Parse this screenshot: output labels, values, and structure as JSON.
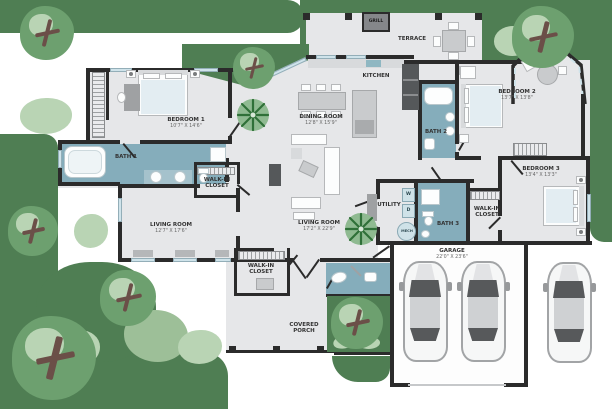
{
  "image_type": "top-view floor plan illustration",
  "colors": {
    "lawn": "#4f7e53",
    "tree": "#6da06f",
    "tree_light": "#b9d4b4",
    "tree_mid": "#9dbf98",
    "floor": "#e6e7e9",
    "wall": "#2b2b2b",
    "bath": "#85adbb",
    "furniture": "#c9cbcd",
    "appliance": "#55585a"
  },
  "rooms": {
    "bedroom1": {
      "name": "BEDROOM 1",
      "dims": "10'7\" X 14'6\""
    },
    "bath1": {
      "name": "BATH 1"
    },
    "closet1": {
      "name": "WALK-IN CLOSET"
    },
    "living1": {
      "name": "LIVING ROOM",
      "dims": "12'7\" X 17'6\""
    },
    "dining": {
      "name": "DINING ROOM",
      "dims": "12'8\" X 15'9\""
    },
    "kitchen": {
      "name": "KITCHEN"
    },
    "terrace": {
      "name": "TERRACE"
    },
    "grill": {
      "name": "GRILL"
    },
    "bedroom2": {
      "name": "BEDROOM 2",
      "dims": "13'7\" X 13'8\""
    },
    "bath2": {
      "name": "BATH 2"
    },
    "bedroom3": {
      "name": "BEDROOM 3",
      "dims": "13'4\" X 13'3\""
    },
    "closet2": {
      "name": "WALK-IN CLOSET"
    },
    "utility": {
      "name": "UTILITY"
    },
    "washer": {
      "name": "W"
    },
    "dryer": {
      "name": "D"
    },
    "mech": {
      "name": "MECH"
    },
    "bath3": {
      "name": "BATH 3"
    },
    "living2": {
      "name": "LIVING ROOM",
      "dims": "17'2\" X 22'9\""
    },
    "closet3": {
      "name": "WALK-IN CLOSET"
    },
    "garage": {
      "name": "GARAGE",
      "dims": "22'0\" X 23'6\""
    },
    "porch": {
      "name": "COVERED PORCH"
    }
  }
}
